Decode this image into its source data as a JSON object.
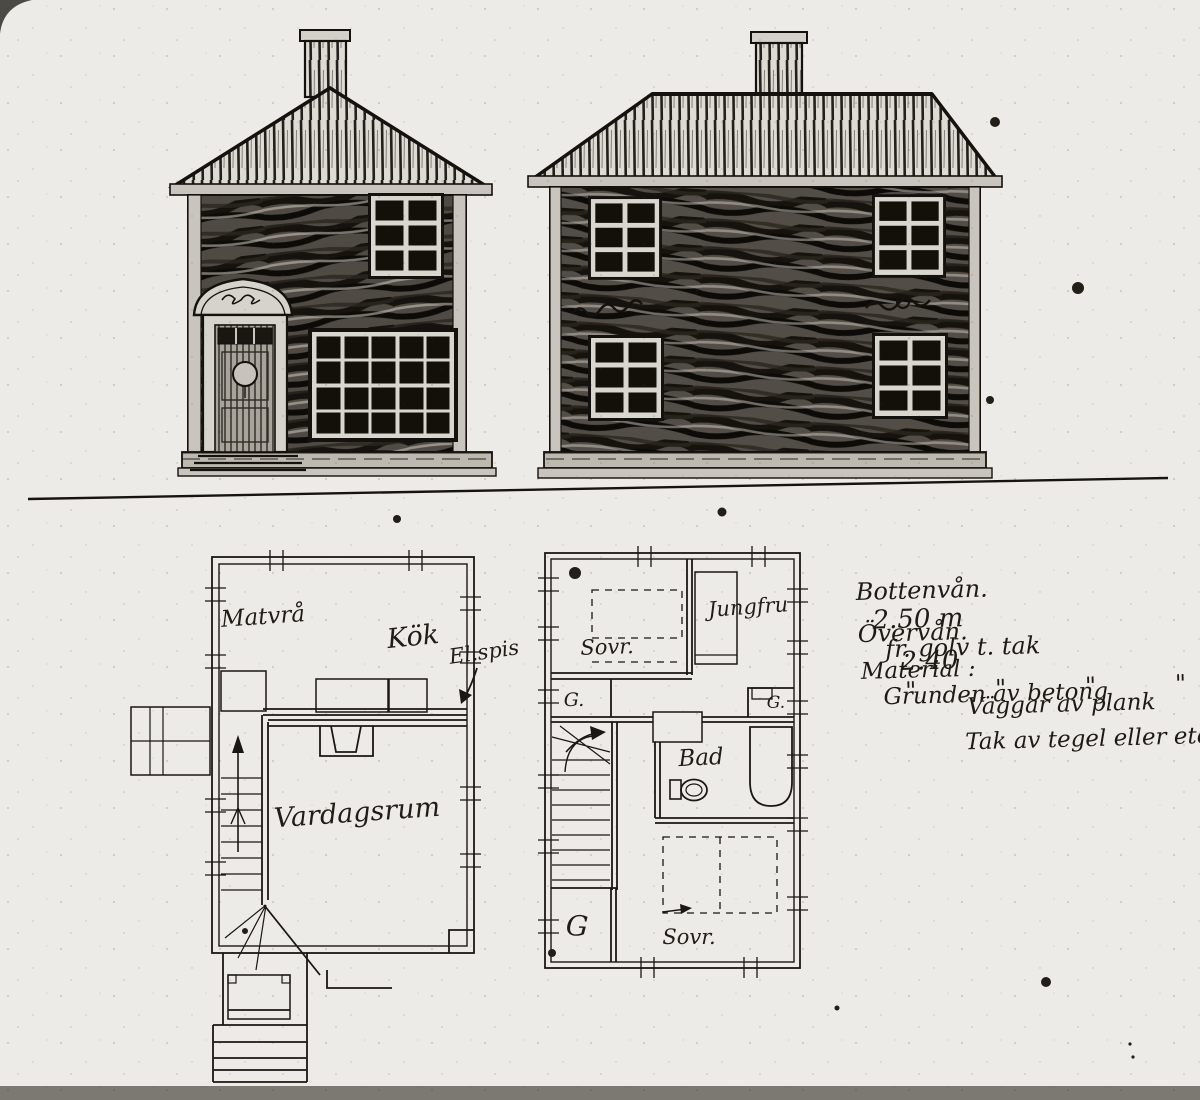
{
  "photo": {
    "paper_color": "#edebe7",
    "ink_color": "#1b1712",
    "bottom_strip_color": "#7b7972"
  },
  "ground_floor_plan": {
    "labels": {
      "matvra": "Matvrå",
      "kok": "Kök",
      "el_spis": "El.spis",
      "vardagsrum": "Vardagsrum"
    }
  },
  "upper_floor_plan": {
    "labels": {
      "sovr_top": "Sovr.",
      "jungfru": "Jungfru",
      "g_top_left": "G.",
      "g_top_right": "G.",
      "bad": "Bad",
      "g_bottom": "G",
      "sovr_bottom": "Sovr."
    }
  },
  "notes": {
    "row1": {
      "label": "Bottenvån.",
      "value": "2.50 m",
      "suffix": "fr. golv t. tak"
    },
    "row2": {
      "label": "Övervån.",
      "value": "2.40",
      "suffix": "\"   \"   \"   \""
    },
    "row3": {
      "label": "Material :",
      "value": "Grunden av betong"
    },
    "row4": {
      "value": "Väggar av plank"
    },
    "row5": {
      "value": "Tak av tegel eller eternit"
    }
  }
}
